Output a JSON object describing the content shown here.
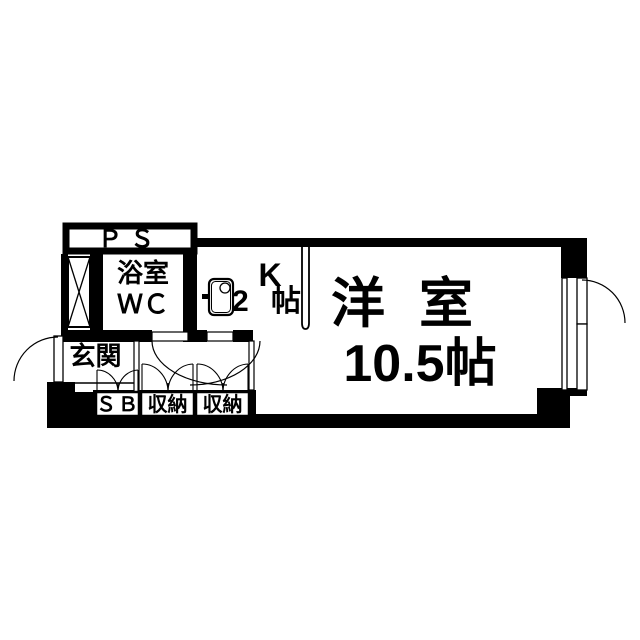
{
  "floor_plan": {
    "background_color": "#ffffff",
    "wall_color": "#000000",
    "rooms": {
      "ps": {
        "label": "ＰＳ"
      },
      "bathroom": {
        "label_line1": "浴室",
        "label_line2": "ＷＣ"
      },
      "kitchen": {
        "label": "K",
        "size": "2 帖"
      },
      "western_room": {
        "label": "洋 室",
        "size": "10.5帖"
      },
      "entrance": {
        "label": "玄関"
      },
      "shoe_box": {
        "label": "ＳＢ"
      },
      "storage_1": {
        "label": "収納"
      },
      "storage_2": {
        "label": "収納"
      }
    }
  }
}
